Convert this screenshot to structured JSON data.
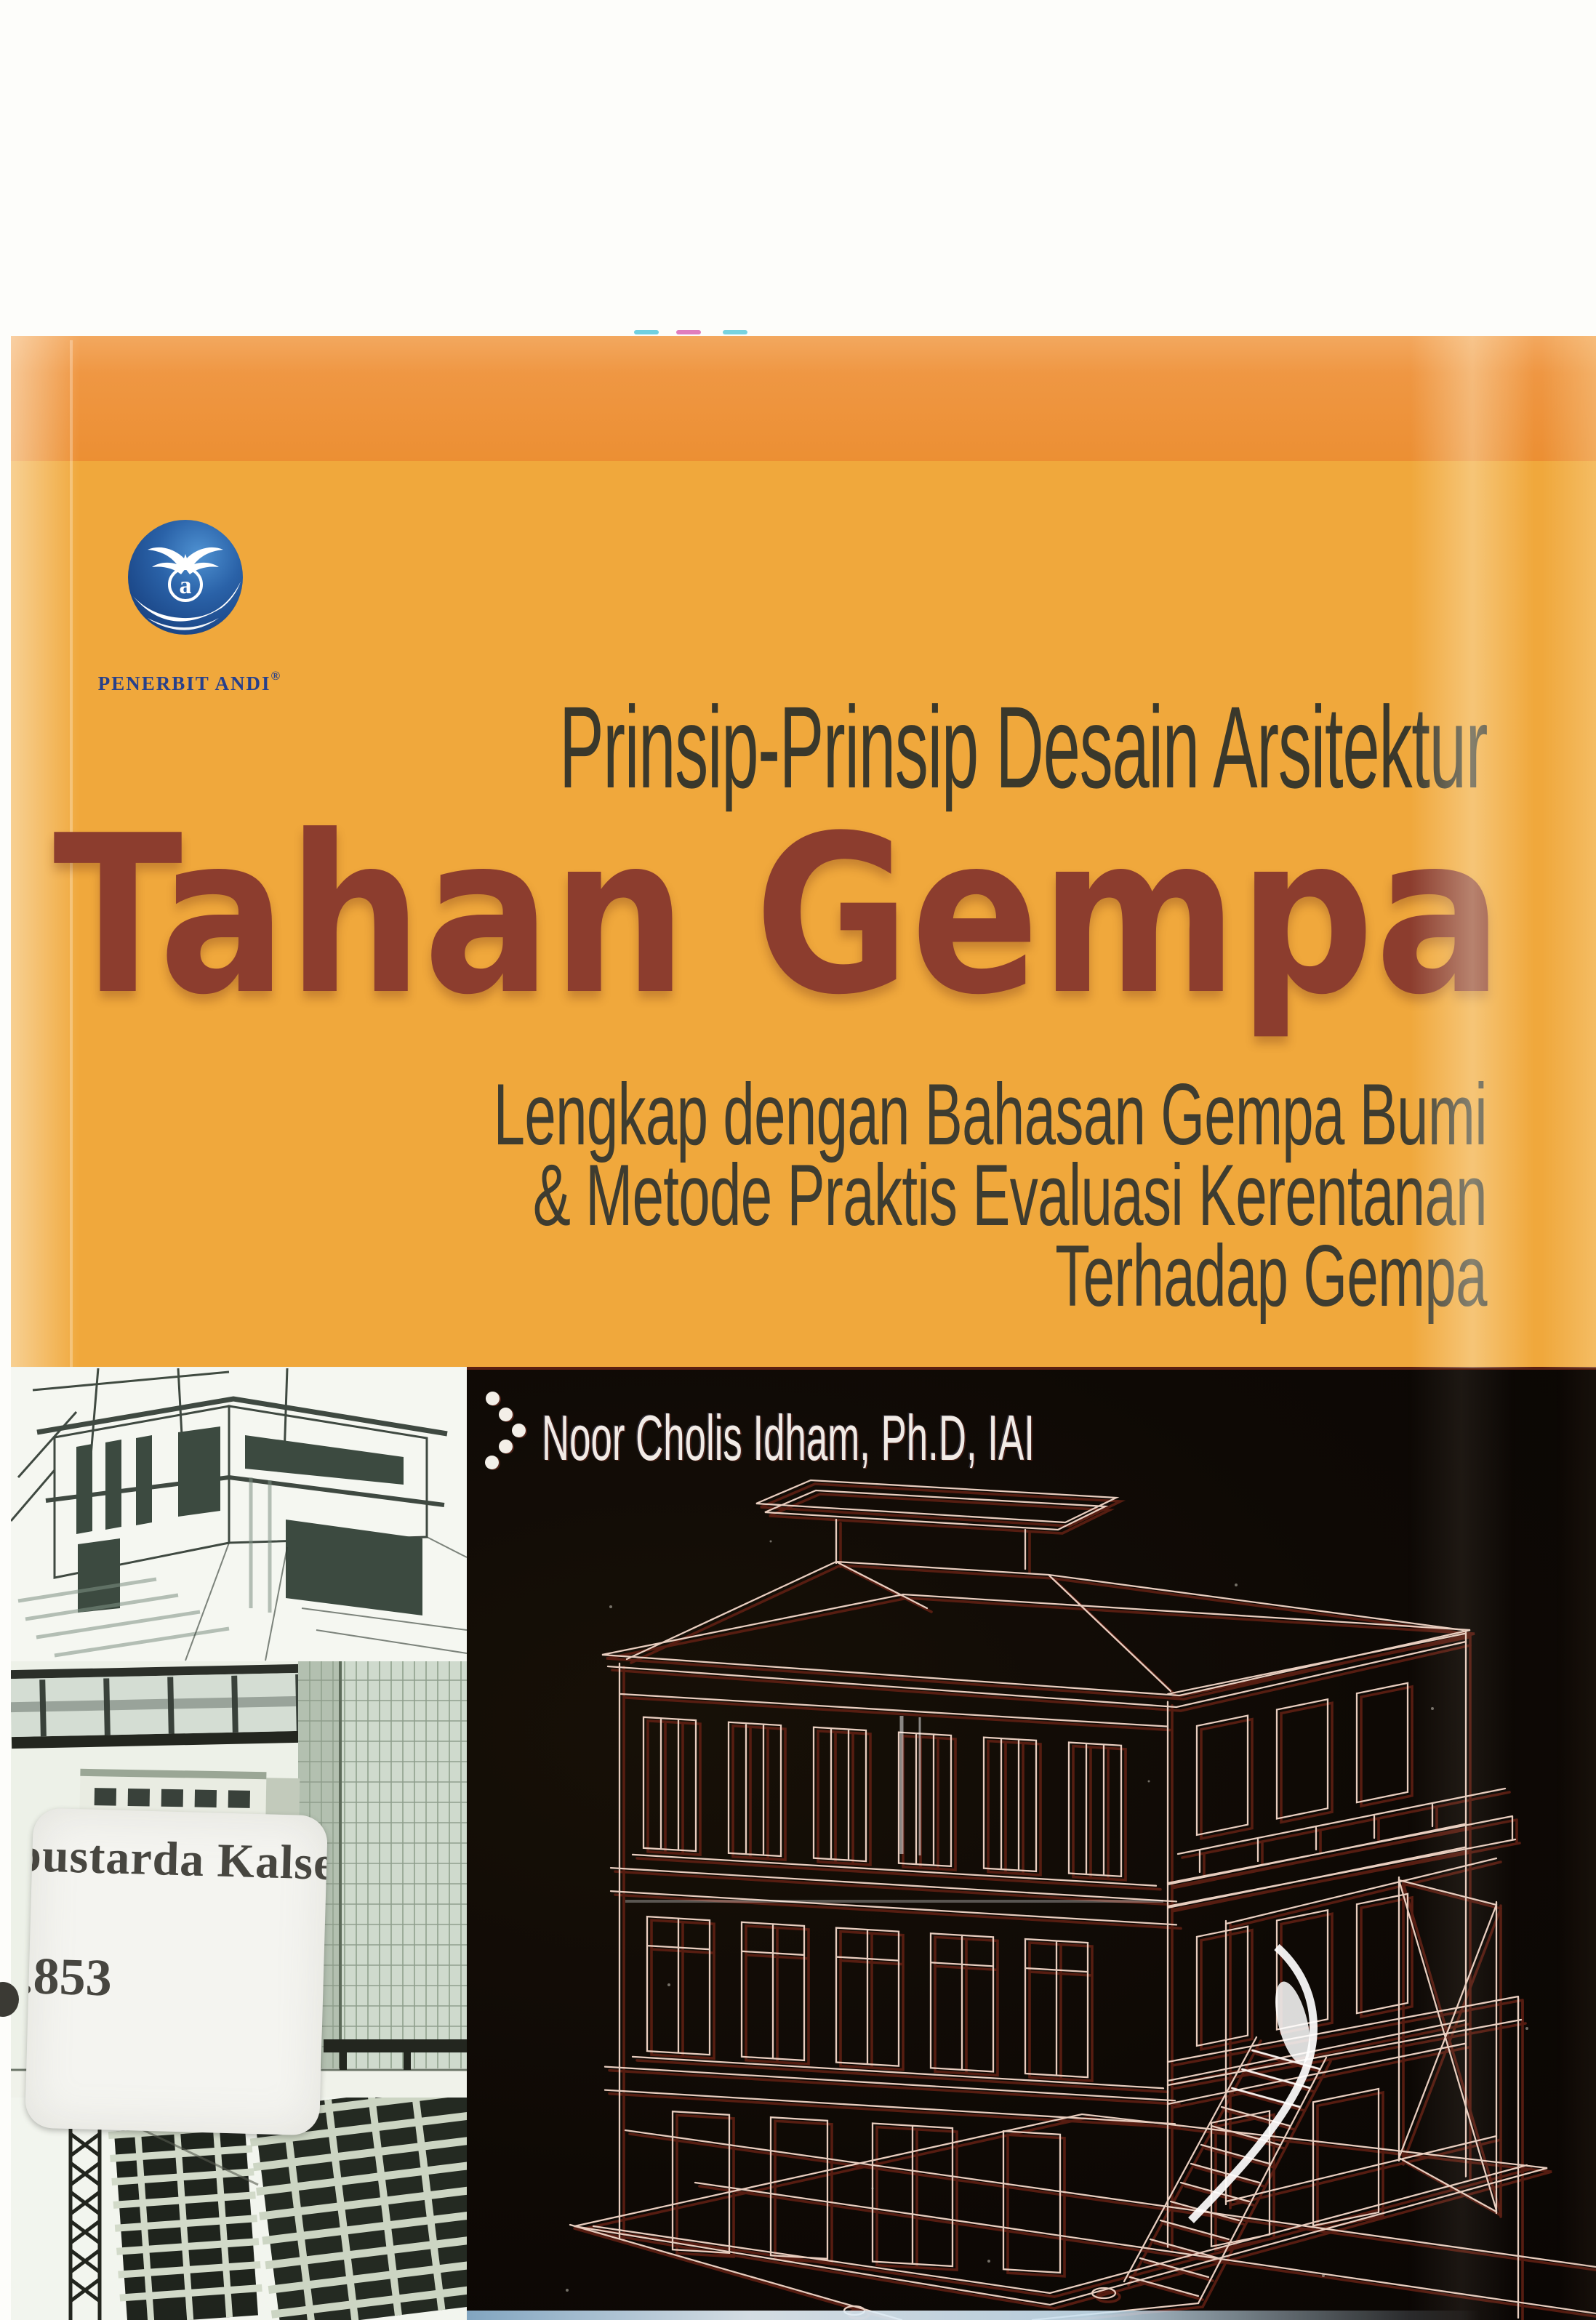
{
  "cover": {
    "publisher": {
      "logo_text": "PENERBIT ANDI",
      "registered_mark": "®"
    },
    "series_title": "Prinsip-Prinsip Desain Arsitektur",
    "main_title": "Tahan Gempa",
    "subtitle_lines": [
      "Lengkap dengan Bahasan Gempa Bumi",
      "& Metode Praktis Evaluasi Kerentanan",
      "Terhadap Gempa"
    ],
    "author": "Noor Cholis Idham, Ph.D, IAI"
  },
  "library_sticker": {
    "line1": "pustarda Kalsel",
    "line2": ".853"
  },
  "colors": {
    "band_orange": "#EC8F33",
    "cover_amber": "#F0A83C",
    "title_maroon": "#8C3D2E",
    "heading_dark": "#3A382B",
    "black_background": "#0E0905",
    "author_white": "#F1EBE6",
    "logo_blue": "#27408B",
    "sticker_background": "#F4F4F0"
  },
  "images": {
    "logo_icon": "andi-globe-bird-logo",
    "ornament_icon": "five-dot-chevron",
    "sketch": "modern-house-architectural-sketch",
    "tower_photo": "high-rise-buildings-photo",
    "construction_photo": "construction-site-with-tower-crane",
    "wireframe": "3d-wireframe-model-of-multistorey-house"
  }
}
